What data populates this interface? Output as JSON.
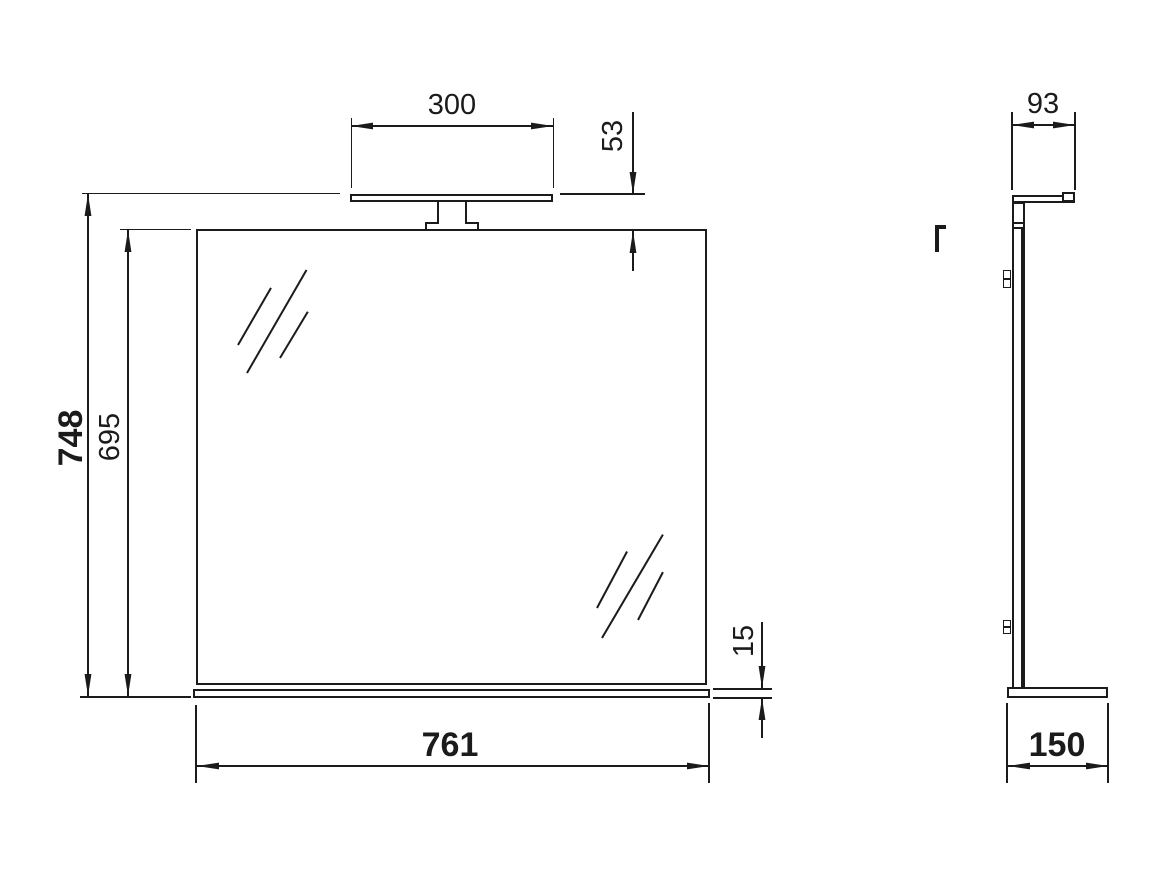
{
  "colors": {
    "line": "#1b1b1b",
    "background": "#ffffff"
  },
  "views": {
    "front": {
      "label_lamp_width": "300",
      "label_lamp_to_mirror_gap": "53",
      "label_overall_height": "748",
      "label_mirror_height": "695",
      "label_shelf_thickness": "15",
      "label_overall_width": "761"
    },
    "side": {
      "label_lamp_depth": "93",
      "label_base_depth": "150"
    }
  }
}
